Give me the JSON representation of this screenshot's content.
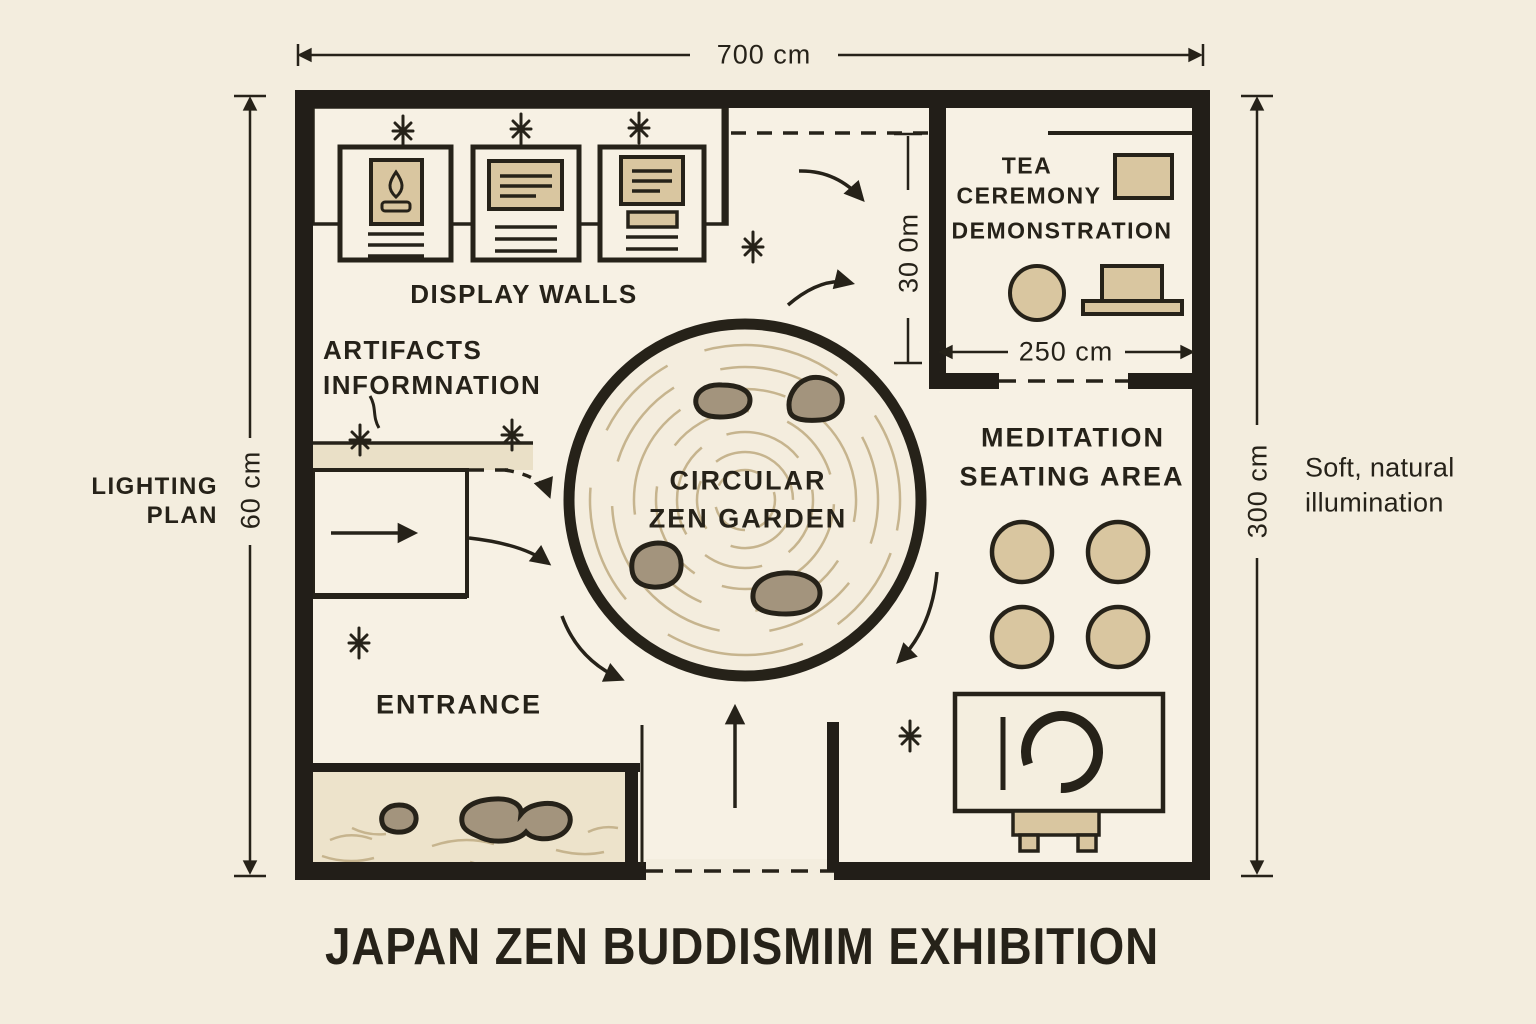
{
  "title": "JAPAN ZEN BUDDISMIM EXHIBITION",
  "dimensions": {
    "width_top": "700 cm",
    "height_left": "60 cm",
    "height_right": "300 cm",
    "tea_room_height": "30 0m",
    "tea_room_width": "250 cm"
  },
  "areas": {
    "display_walls": {
      "label": "DISPLAY WALLS"
    },
    "artifacts_info": {
      "line1": "ARTIFACTS",
      "line2": "INFORMNATION"
    },
    "lighting_plan": {
      "line1": "LIGHTING",
      "line2": "PLAN"
    },
    "tea_ceremony": {
      "line1": "TEA",
      "line2": "CEREMONY",
      "line3": "DEMONSTRATION"
    },
    "zen_garden": {
      "line1": "CIRCULAR",
      "line2": "ZEN GARDEN"
    },
    "meditation": {
      "line1": "MEDITATION",
      "line2": "SEATING AREA"
    },
    "entrance": {
      "label": "ENTRANCE"
    }
  },
  "notes": {
    "illumination": {
      "line1": "Soft, natural",
      "line2": "illumination"
    }
  },
  "colors": {
    "bg": "#f3edde",
    "plan": "#f7f1e4",
    "wall": "#221e18",
    "ink": "#262219",
    "tan": "#d9c6a0",
    "sand": "#ede3cb",
    "rock": "#a3947d",
    "sandline": "#c6b48e"
  }
}
